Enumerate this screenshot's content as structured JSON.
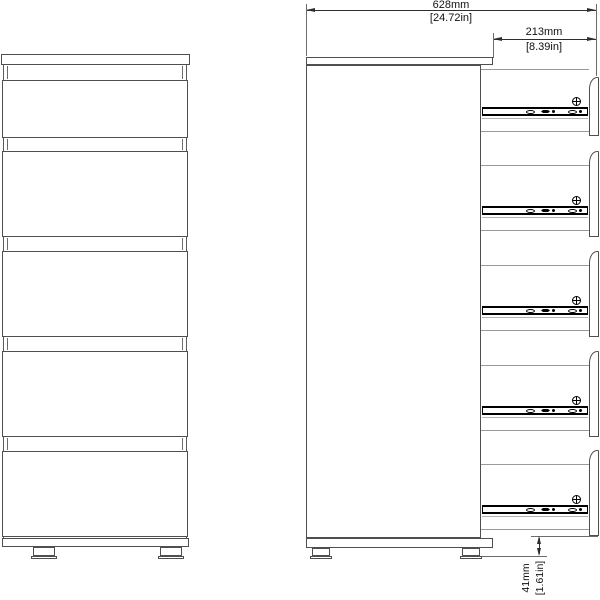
{
  "diagram": {
    "views": [
      "front",
      "side"
    ],
    "drawer_count": 5,
    "rail_count": 5,
    "screw_count": 5,
    "feet_per_view": 2
  },
  "dimensions": {
    "width": {
      "mm": "628mm",
      "in": "[24.72in]"
    },
    "depth": {
      "mm": "213mm",
      "in": "[8.39in]"
    },
    "foot": {
      "mm": "41mm",
      "in": "[1.61in]"
    }
  },
  "colors": {
    "background": "#ffffff",
    "outline": "#4f4f4f",
    "light_line": "#9a9a9a",
    "rail": "#000000",
    "dimension": "#2e2e2e"
  }
}
